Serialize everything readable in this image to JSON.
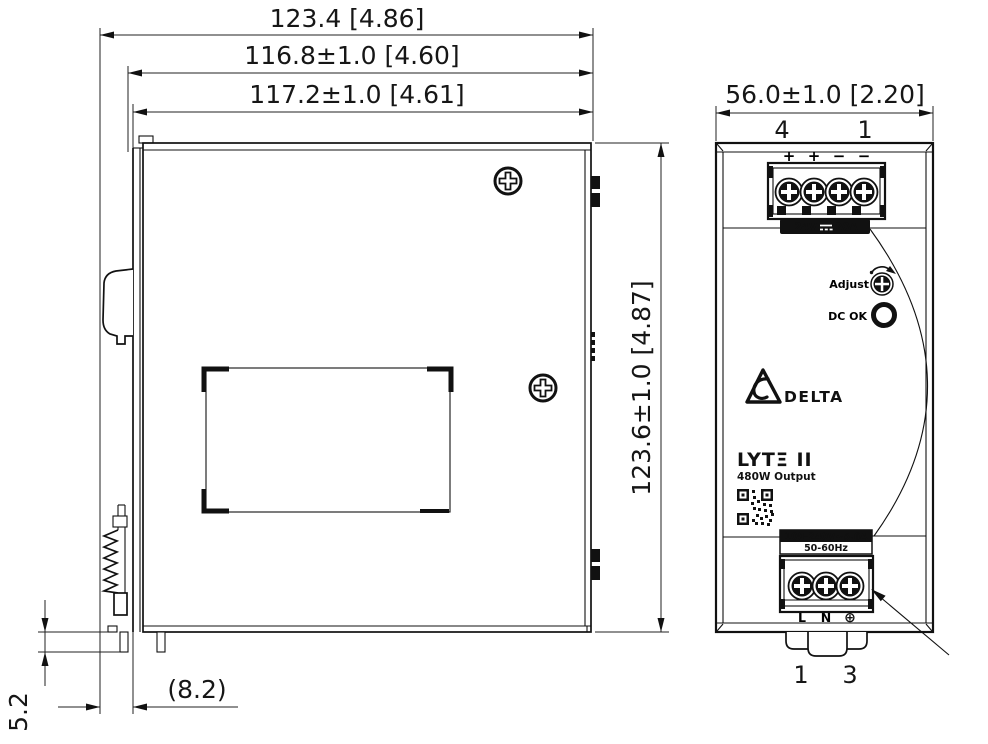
{
  "colors": {
    "line": "#111111",
    "background": "#ffffff",
    "label_bg": "#000000",
    "label_text": "#ffffff"
  },
  "side_view": {
    "dim_overall_width": "123.4 [4.86]",
    "dim_body_width": "116.8±1.0 [4.60]",
    "dim_case_width": "117.2±1.0 [4.61]",
    "dim_height": "123.6±1.0 [4.87]",
    "dim_clip_gap": "(8.2)",
    "dim_clip_protrusion": "5.2"
  },
  "front_view": {
    "dim_width": "56.0±1.0 [2.20]",
    "terminal_top": {
      "pin_left": "4",
      "pin_right": "1",
      "polarity": [
        "+",
        "+",
        "−",
        "−"
      ],
      "rating_voltage": "24V",
      "rating_current": "20A",
      "dc_symbol": "⎓"
    },
    "panel": {
      "adjust_label": "Adjust",
      "dc_ok_label": "DC OK",
      "brand": "DELTA",
      "model": "LYTΞ II",
      "output_power": "480W Output",
      "input_rating": "100-240V~5.6A",
      "input_frequency": "50-60Hz"
    },
    "terminal_bottom": {
      "labels": [
        "L",
        "N",
        "⊕"
      ],
      "pin_left": "1",
      "pin_right": "3"
    }
  }
}
